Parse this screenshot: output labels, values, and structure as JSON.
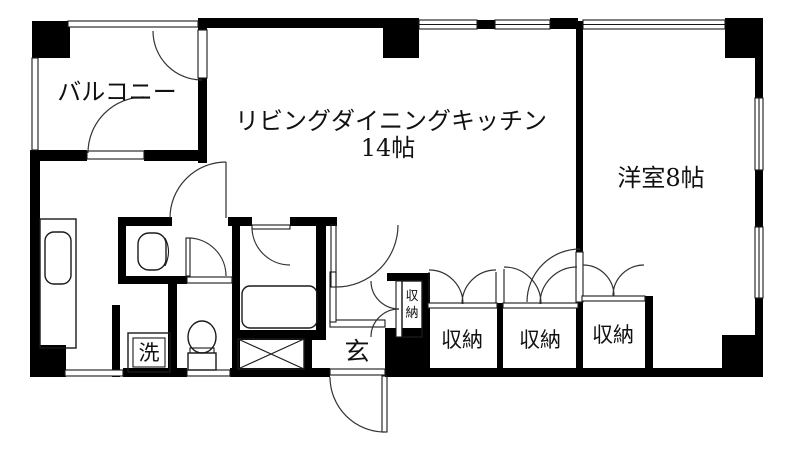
{
  "colors": {
    "wall": "#000000",
    "line": "#1a1a1a",
    "background": "#ffffff",
    "text": "#111111"
  },
  "labels": {
    "balcony": "バルコニー",
    "ldk_line1": "リビングダイニングキッチン",
    "ldk_line2": "14帖",
    "western_room": "洋室8帖",
    "closet_1": "収納",
    "closet_2": "収納",
    "closet_3": "収納",
    "closet_small_char1": "収",
    "closet_small_char2": "納",
    "entrance": "玄",
    "laundry": "洗"
  }
}
